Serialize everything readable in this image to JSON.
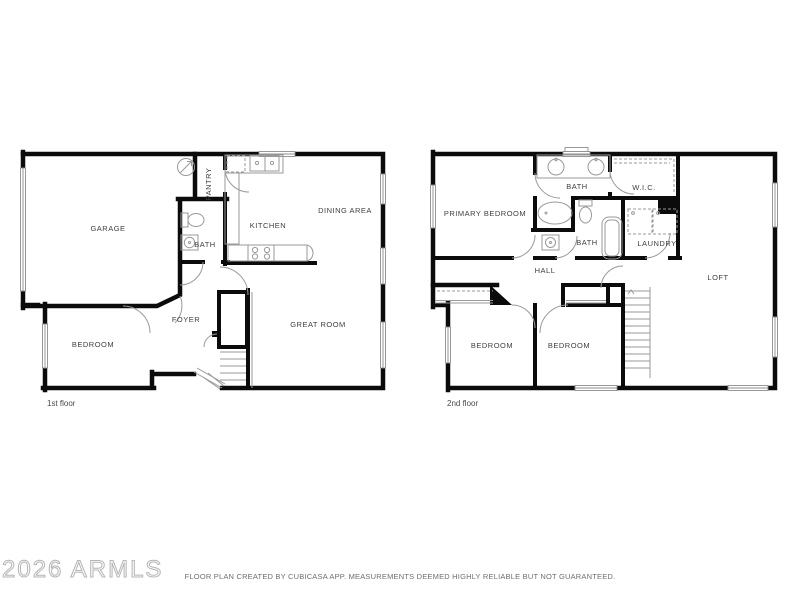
{
  "canvas": {
    "background": "#ffffff",
    "wall_color": "#0b0b0b",
    "fixture_line_color": "#9a9a9a",
    "label_color": "#3f3f3f"
  },
  "watermark": {
    "text": "2026 ARMLS",
    "color": "#b5b5b5"
  },
  "footer": {
    "disclaimer": "FLOOR PLAN CREATED BY CUBICASA APP. MEASUREMENTS DEEMED HIGHLY RELIABLE BUT NOT GUARANTEED."
  },
  "floor1": {
    "caption": "1st floor",
    "rooms": {
      "garage": "GARAGE",
      "pantry": "PANTRY",
      "kitchen": "KITCHEN",
      "dining": "DINING AREA",
      "bath": "BATH",
      "foyer": "FOYER",
      "bedroom": "BEDROOM",
      "great_room": "GREAT ROOM"
    }
  },
  "floor2": {
    "caption": "2nd floor",
    "rooms": {
      "primary_bedroom": "PRIMARY BEDROOM",
      "bath_upper": "BATH",
      "wic": "W.I.C.",
      "bath_lower": "BATH",
      "laundry": "LAUNDRY",
      "hall": "HALL",
      "loft": "LOFT",
      "bedroom_left": "BEDROOM",
      "bedroom_right": "BEDROOM"
    }
  }
}
